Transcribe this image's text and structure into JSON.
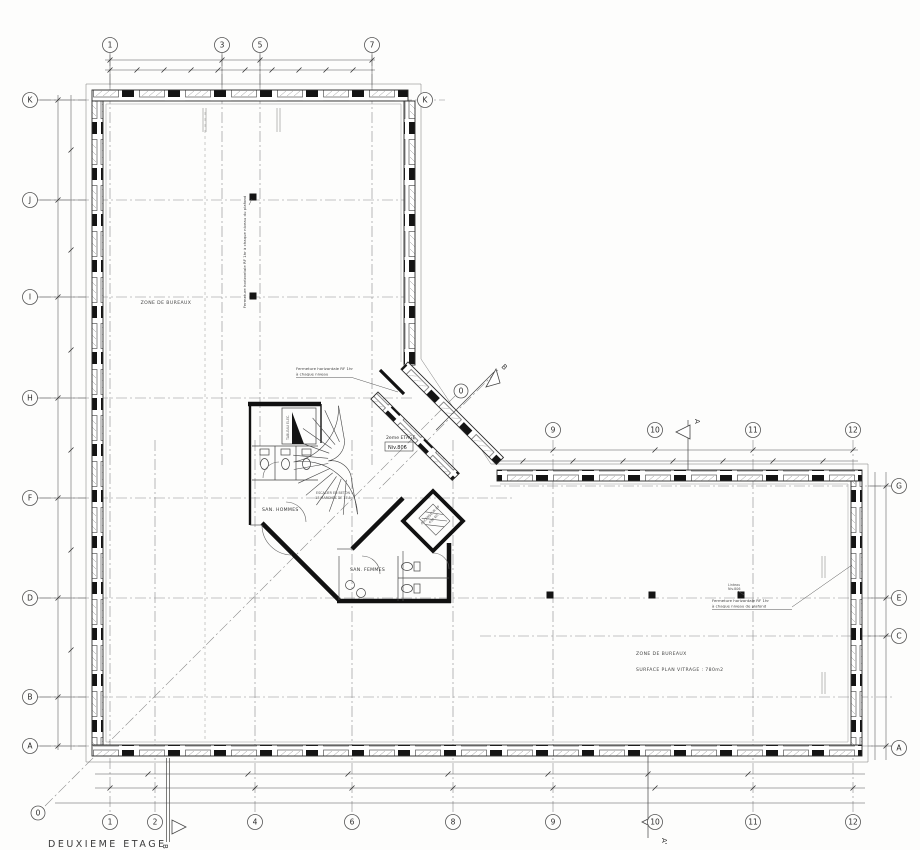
{
  "title": "DEUXIEME ETAGE",
  "grid": {
    "top_row": [
      "1",
      "3",
      "5",
      "7"
    ],
    "top_right_k": "K",
    "left_col": [
      "K",
      "J",
      "I",
      "H",
      "F",
      "D",
      "B",
      "A"
    ],
    "right_col": [
      "G",
      "E",
      "C",
      "A"
    ],
    "mid_row": [
      "9",
      "10",
      "11",
      "12"
    ],
    "bottom_row": [
      "1",
      "2",
      "4",
      "6",
      "8",
      "9",
      "10",
      "11",
      "12"
    ],
    "diag_axis_low": "0",
    "diag_axis_high": "0"
  },
  "sections": {
    "a": "A",
    "a_prime": "A'",
    "b": "B",
    "b_prime": "B"
  },
  "rooms": {
    "zone_left": "ZONE DE BUREAUX",
    "zone_right": "ZONE DE BUREAUX",
    "surface": "SURFACE PLAN VITRAGE : 780m2",
    "san_hommes": "SAN. HOMMES",
    "san_femmes": "SAN. FEMMES",
    "stair_1": "ESCALIER EN BETON",
    "stair_2": "18 MARCHES DE 17.5",
    "elevator_1": "ASCENSEUR 8P",
    "elevator_2": "630 KG",
    "level_label": "2eme ETAGE",
    "level_value": "Niv.806",
    "tableau": "TABLEAU ELEC."
  },
  "notes": {
    "fermeture_top_1": "Fermeture horizontale RF  1hr",
    "fermeture_top_2": "à chaque niveau",
    "fermeture_right_1": "Fermeture horizontale RF  1hr",
    "fermeture_right_2": "à chaque niveau de plafond",
    "fermeture_vert": "Fermeture horizontale RF 1hr à chaque niveau du plafond",
    "linteau_1": "Linteau",
    "linteau_2": "Niv.806"
  },
  "colors": {
    "ink": "#2a2a2a",
    "axis": "#8a8a8a",
    "poche": "#111111"
  }
}
